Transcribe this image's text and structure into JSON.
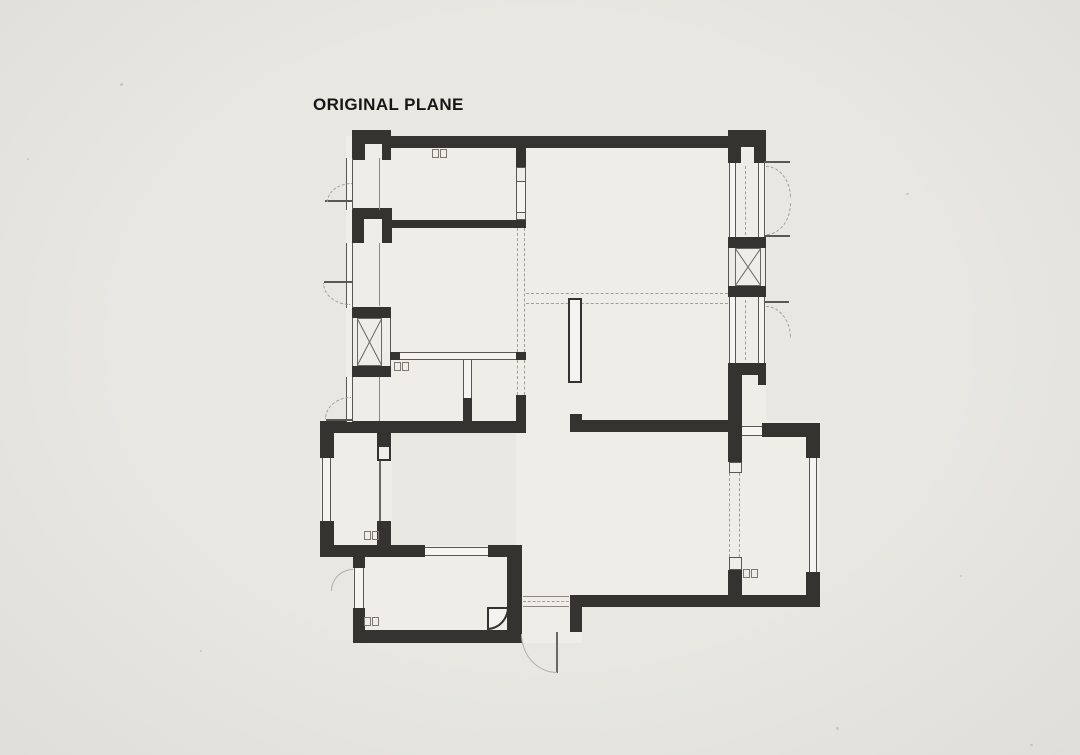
{
  "title": "ORIGINAL PLANE",
  "palette": {
    "background": "#e8e7e2",
    "floor": "#eeede8",
    "wall": "#343330",
    "line": "#5a5852",
    "dash": "#a19e96",
    "light_line": "#b3b0a8",
    "title_color": "#161616"
  },
  "drawing": {
    "type": "architectural-floor-plan",
    "symbols": {
      "shaft": "box-with-x-cross",
      "window": "double-thin-line",
      "door": "quarter-arc-swing",
      "beam": "double-dashed-line",
      "casement": "dashed-quarter-arc"
    }
  }
}
